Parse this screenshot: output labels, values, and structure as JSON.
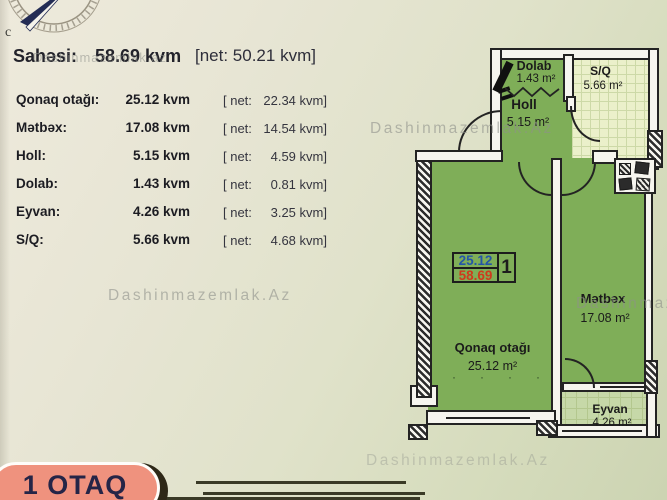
{
  "header": {
    "label": "Sahəsi:",
    "value": "58.69 kvm",
    "net": "[net: 50.21 kvm]"
  },
  "watermark": {
    "text": "Dashinmazemlak.Az",
    "title_overlay": "Dashinmazemlak.az"
  },
  "table": {
    "rows": [
      {
        "label": "Qonaq otağı:",
        "value": "25.12 kvm",
        "net_prefix": "[ net:",
        "net_value": "22.34",
        "net_suffix": " kvm]"
      },
      {
        "label": "Mətbəx:",
        "value": "17.08 kvm",
        "net_prefix": "[ net:",
        "net_value": "14.54",
        "net_suffix": " kvm]"
      },
      {
        "label": "Holl:",
        "value": "5.15 kvm",
        "net_prefix": "[ net:",
        "net_value": "4.59",
        "net_suffix": " kvm]"
      },
      {
        "label": "Dolab:",
        "value": "1.43 kvm",
        "net_prefix": "[ net:",
        "net_value": "0.81",
        "net_suffix": " kvm]"
      },
      {
        "label": "Eyvan:",
        "value": "4.26 kvm",
        "net_prefix": "[ net:",
        "net_value": "3.25",
        "net_suffix": " kvm]"
      },
      {
        "label": "S/Q:",
        "value": "5.66 kvm",
        "net_prefix": "[ net:",
        "net_value": "4.68",
        "net_suffix": " kvm]"
      }
    ]
  },
  "plan": {
    "rooms": {
      "dolab": {
        "name": "Dolab",
        "area": "1.43 m²"
      },
      "sq": {
        "name": "S/Q",
        "area": "5.66 m²"
      },
      "holl": {
        "name": "Holl",
        "area": "5.15 m²"
      },
      "qonaq": {
        "name": "Qonaq otağı",
        "area": "25.12 m²"
      },
      "metbex": {
        "name": "Mətbəx",
        "area": "17.08 m²"
      },
      "eyvan": {
        "name": "Eyvan",
        "area": "4.26 m²"
      }
    },
    "badge": {
      "net": "25.12",
      "gross": "58.69",
      "number": "1"
    },
    "dots": "····"
  },
  "footer": {
    "label": "1 OTAQ"
  },
  "colors": {
    "room_green": "#7fae58",
    "eyvan_green": "#c6d8a8",
    "tile": "#ebf0ca",
    "badge_blue": "#2456a8",
    "badge_red": "#cf3a1c",
    "pill": "#ef927e"
  }
}
